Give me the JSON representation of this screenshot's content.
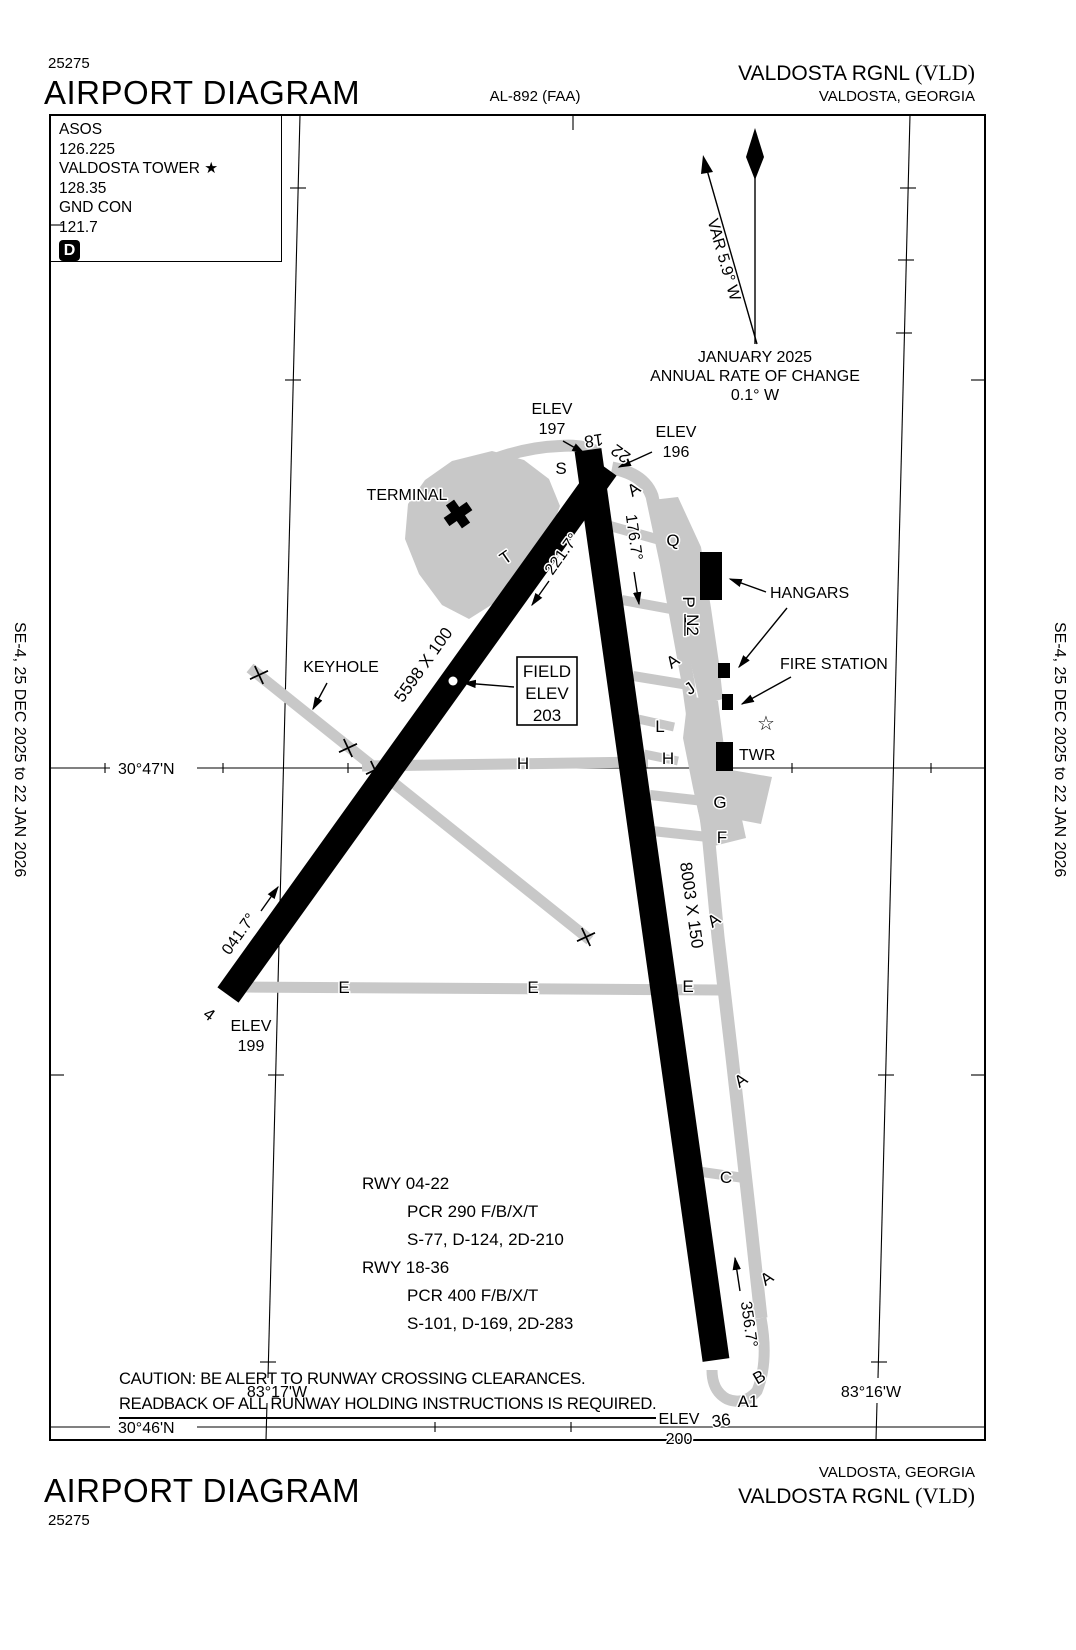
{
  "page": {
    "edition_left": "SE-4,  25 DEC 2025  to  22 JAN 2026",
    "edition_right": "SE-4,  25 DEC 2025  to  22 JAN 2026"
  },
  "header": {
    "chart_number": "25275",
    "title": "AIRPORT DIAGRAM",
    "procedure_id": "AL-892 (FAA)",
    "airport_name": "VALDOSTA RGNL",
    "airport_icao": "(VLD)",
    "city": "VALDOSTA, GEORGIA"
  },
  "footer": {
    "title": "AIRPORT DIAGRAM",
    "chart_number": "25275",
    "airport_name": "VALDOSTA RGNL",
    "airport_icao": "(VLD)",
    "city": "VALDOSTA, GEORGIA"
  },
  "comm_box": {
    "lines": [
      "ASOS",
      "126.225",
      "VALDOSTA TOWER ★",
      "128.35",
      "GND CON",
      "121.7"
    ],
    "atis_badge": "D"
  },
  "compass": {
    "variation": "VAR 5.9° W",
    "date": "JANUARY 2025",
    "rate_label": "ANNUAL RATE OF CHANGE",
    "rate_value": "0.1° W"
  },
  "graticule": {
    "lat_upper": "30°47'N",
    "lat_lower": "30°46'N",
    "lon_west": "83°17'W",
    "lon_east": "83°16'W"
  },
  "runway_04_22": {
    "num_04": "4",
    "num_22": "22",
    "size": "5598 X 100",
    "hdg_04": "041.7°",
    "hdg_22": "221.7°",
    "elev_04": [
      "ELEV",
      "199"
    ]
  },
  "runway_18_36": {
    "num_18": "18",
    "num_36": "36",
    "size": "8003 X 150",
    "hdg_18": "176.7°",
    "hdg_36": "356.7°",
    "elev_18": [
      "ELEV",
      "197"
    ],
    "elev_36": [
      "ELEV",
      "200"
    ]
  },
  "elev_196": [
    "ELEV",
    "196"
  ],
  "field_elev": [
    "FIELD",
    "ELEV",
    "203"
  ],
  "features": {
    "terminal": "TERMINAL",
    "hangars": "HANGARS",
    "fire_station": "FIRE STATION",
    "tower": "TWR",
    "keyhole": "KEYHOLE",
    "beacon": "☆"
  },
  "taxiways": {
    "a": "A",
    "a1": "A1",
    "b": "B",
    "c": "C",
    "e": "E",
    "f": "F",
    "g": "G",
    "h": "H",
    "j": "J",
    "l": "L",
    "n2": "N2",
    "p": "P",
    "q": "Q",
    "s": "S",
    "t": "T"
  },
  "notes": {
    "rwy1": "RWY 04-22",
    "rwy1_pcr": "PCR 290 F/B/X/T",
    "rwy1_wb": "S-77, D-124, 2D-210",
    "rwy2": "RWY 18-36",
    "rwy2_pcr": "PCR 400 F/B/X/T",
    "rwy2_wb": "S-101, D-169, 2D-283",
    "caution1": "CAUTION: BE ALERT TO RUNWAY CROSSING CLEARANCES.",
    "caution2": "READBACK OF ALL RUNWAY HOLDING INSTRUCTIONS IS REQUIRED."
  },
  "colors": {
    "pavement_gray": "#c8c8c8",
    "ink": "#000000"
  }
}
